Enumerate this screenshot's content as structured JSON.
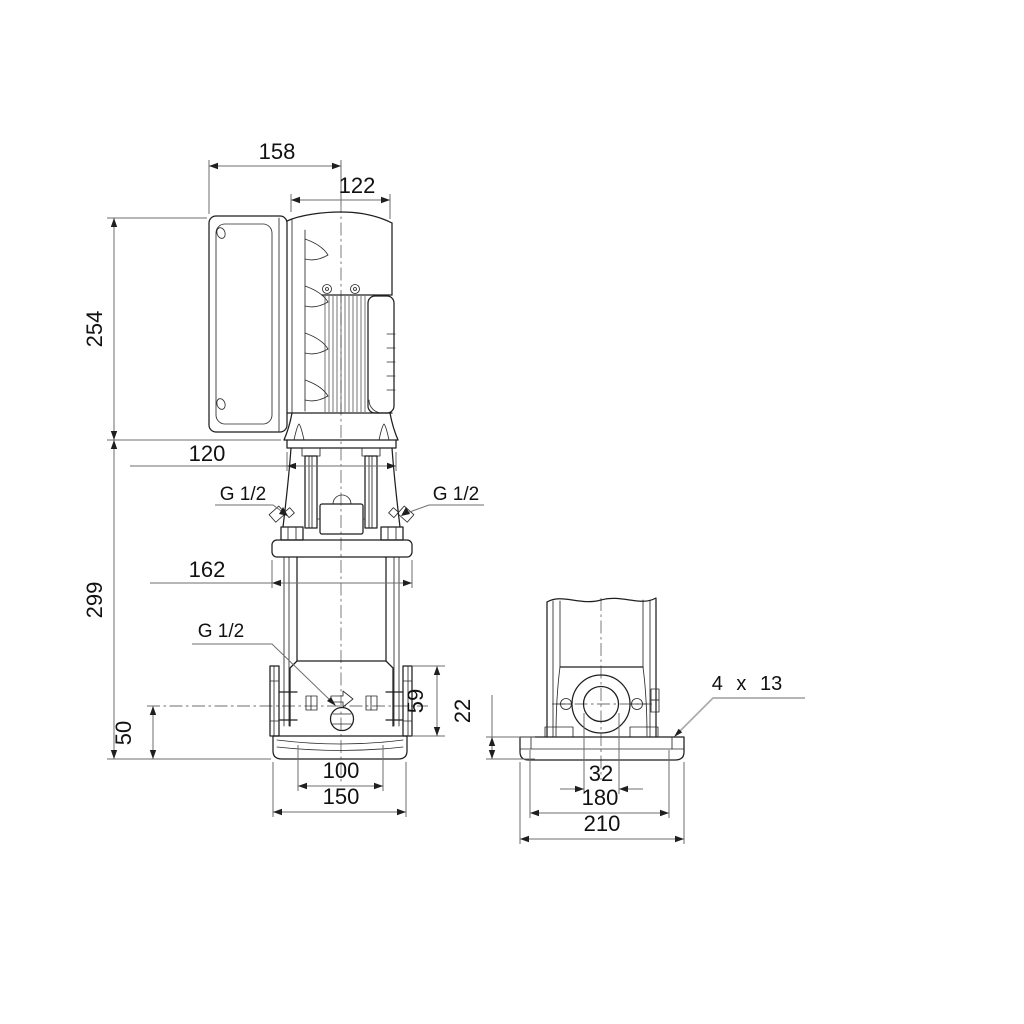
{
  "colors": {
    "background": "#ffffff",
    "line": "#1f1f1f",
    "dimension_line": "#6e6e6e"
  },
  "front_view": {
    "dim_overall_width": "158",
    "dim_motor_width": "122",
    "dim_motor_height": "254",
    "dim_pump_height": "299",
    "dim_flange_span": "120",
    "dim_top_flange_width": "162",
    "label_vent_port_left": "G 1/2",
    "label_vent_port_right": "G 1/2",
    "label_drain_port": "G 1/2",
    "dim_port_center_height": "50",
    "dim_port_section_height": "59",
    "dim_foot_hole_spacing": "100",
    "dim_foot_width": "150"
  },
  "side_view": {
    "dim_base_height": "22",
    "label_mounting_holes": "4 x 13",
    "dim_port_bore": "32",
    "dim_bolt_spacing": "180",
    "dim_base_width": "210"
  }
}
